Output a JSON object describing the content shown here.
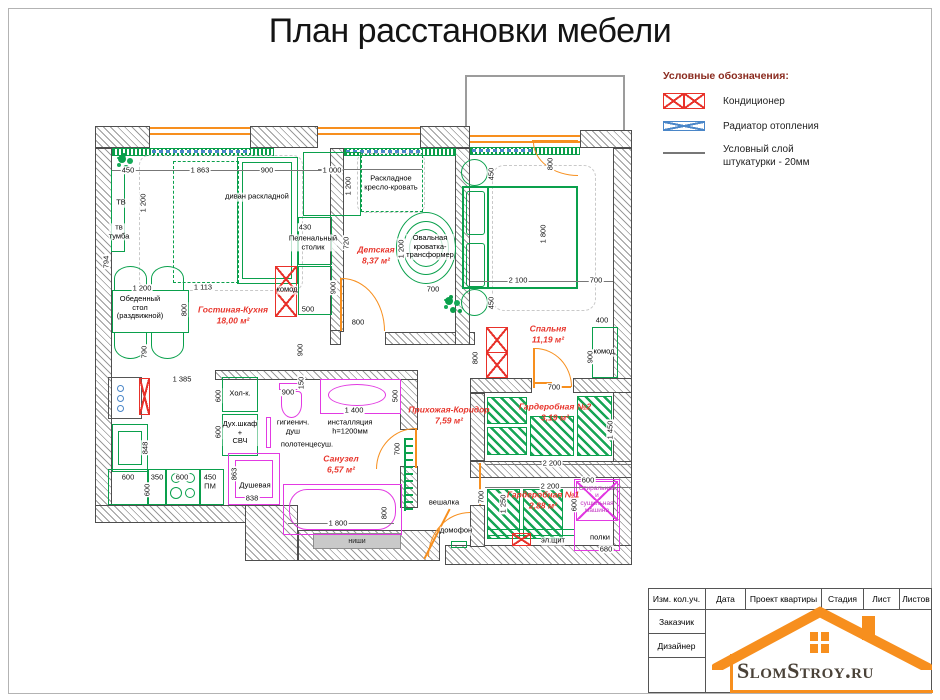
{
  "title": "План расстановки мебели",
  "legend": {
    "heading": "Условные обозначения:",
    "items": [
      "Кондиционер",
      "Радиатор отопления",
      "Условный слой\nштукатурки - 20мм"
    ]
  },
  "rooms": [
    {
      "name": "Гостиная-Кухня",
      "area": "18,00 м²"
    },
    {
      "name": "Детская",
      "area": "8,37 м²"
    },
    {
      "name": "Спальня",
      "area": "11,19 м²"
    },
    {
      "name": "Прихожая-Коридор",
      "area": "7,59 м²"
    },
    {
      "name": "Санузел",
      "area": "6,57 м²"
    },
    {
      "name": "Гардеробная №2",
      "area": "3,19 м²"
    },
    {
      "name": "Гардеробная №1",
      "area": "2,88 м²"
    }
  ],
  "labels": [
    "ТВ",
    "тв\nтумба",
    "диван раскладной",
    "Обеденный\nстол\n(раздвижной)",
    "Раскладное\nкресло-кровать",
    "Пеленальный\nстолик",
    "комод",
    "Овальная\nкроватка-\nтрансформер",
    "комод",
    "Хол-к.",
    "Дух.шкаф\n+\nСВЧ",
    "гигиенич.\nдуш",
    "полотенцесуш.",
    "инсталляция\nh=1200мм",
    "Душевая",
    "вешалка",
    "домофон",
    "ниши",
    "эл.щит",
    "Стиральная\nи\nсушильная\nмашина",
    "полки"
  ],
  "dims": [
    "450",
    "1 863",
    "900",
    "1 200",
    "794",
    "1 200",
    "1 113",
    "800",
    "790",
    "1 385",
    "900",
    "848",
    "600",
    "350",
    "600",
    "450",
    "ПМ",
    "600",
    "600",
    "600",
    "900",
    "150",
    "1 400",
    "500",
    "700",
    "863",
    "838",
    "1 800",
    "800",
    "1 000",
    "1 200",
    "430",
    "720",
    "500",
    "900",
    "800",
    "1 200",
    "700",
    "450",
    "800",
    "1 800",
    "2 100",
    "700",
    "450",
    "400",
    "900",
    "800",
    "700",
    "1 450",
    "2 200",
    "2 200",
    "700",
    "1 250",
    "600",
    "600",
    "680"
  ],
  "titleblock": {
    "cols": [
      "Изм. кол.уч.",
      "Дата",
      "Проект квартиры",
      "Стадия",
      "Лист",
      "Листов"
    ],
    "rows": [
      "Заказчик",
      "Дизайнер"
    ]
  },
  "logo": {
    "text": "SlomStroy.ru"
  },
  "colors": {
    "furniture": "#0aa04c",
    "sanitary": "#e23ae2",
    "ac": "#e8312a",
    "radiator": "#4a86c8",
    "door_window": "#f78f1e",
    "room_label": "#e8352c"
  }
}
